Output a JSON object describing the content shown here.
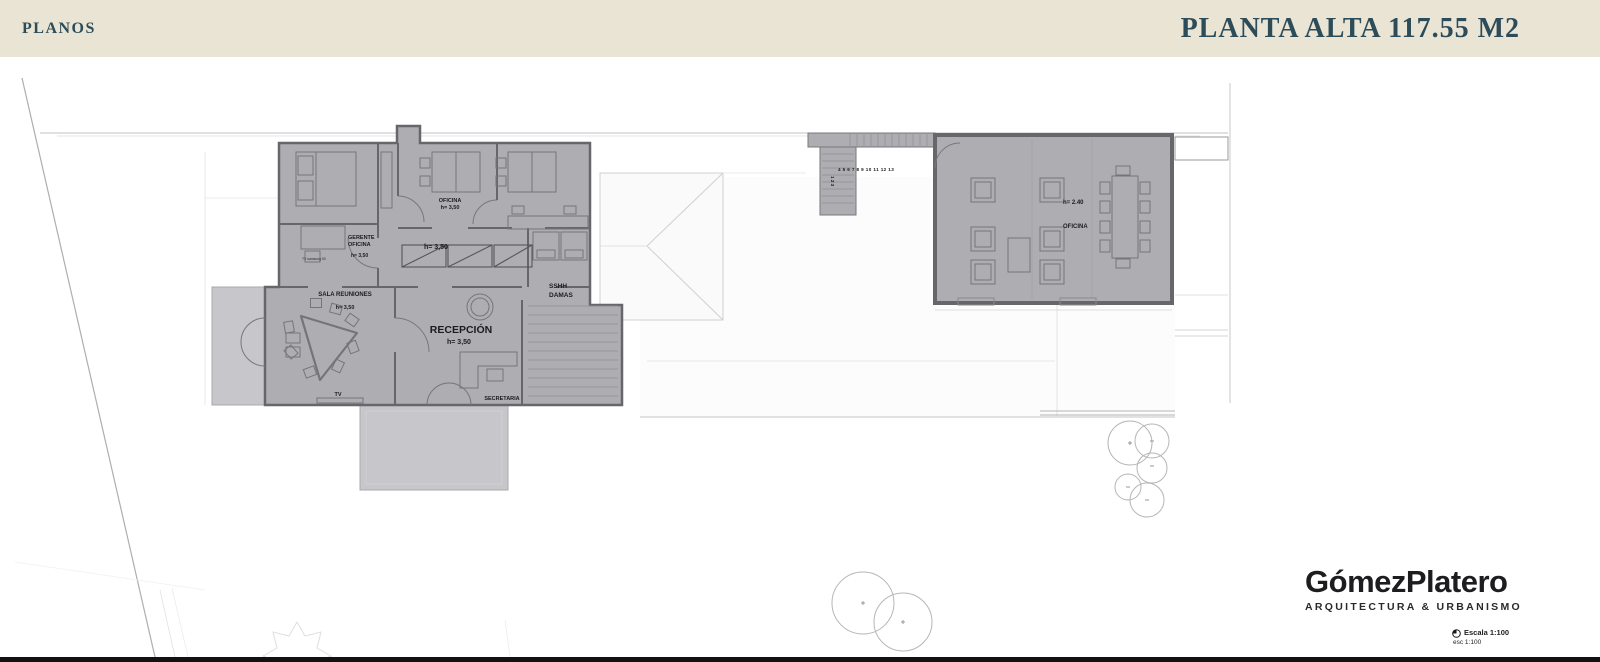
{
  "colors": {
    "header_bg": "#e9e4d3",
    "header_text": "#2d4c59",
    "building_fill": "#aeaeb2",
    "building_fill_light": "#c7c7cb",
    "wall": "#66666b",
    "ink": "#1c1c1e"
  },
  "header": {
    "section": "PLANOS",
    "title": "PLANTA ALTA 117.55 M2"
  },
  "plan": {
    "left_building": {
      "rooms": {
        "oficina": {
          "name": "OFICINA",
          "height": "h= 3,50"
        },
        "pasillo": {
          "height": "h= 3,50"
        },
        "gerente": {
          "name_line1": "GERENTE",
          "name_line2": "OFICINA",
          "height": "h= 3,50",
          "tv_note": "TV samsung 50"
        },
        "sala_reuniones": {
          "name": "SALA REUNIONES",
          "height": "h= 3,50",
          "tv": "TV"
        },
        "recepcion": {
          "name": "RECEPCIÓN",
          "height": "h= 3,50"
        },
        "secretaria": {
          "name": "SECRETARIA"
        },
        "sshh": {
          "name_line1": "SSHH",
          "name_line2": "DAMAS"
        }
      }
    },
    "right_building": {
      "rooms": {
        "oficina": {
          "name": "OFICINA",
          "height": "h= 2.40"
        }
      }
    },
    "stairs": {
      "treads_run": "4 5 6 7 8 9 10 11 12 13",
      "treads_start": "1 2 3"
    }
  },
  "footer": {
    "logo_text": "GómezPlatero",
    "logo_subtitle": "ARQUITECTURA & URBANISMO",
    "scale": "Escala 1:100",
    "scale_alt": "esc 1:100"
  }
}
